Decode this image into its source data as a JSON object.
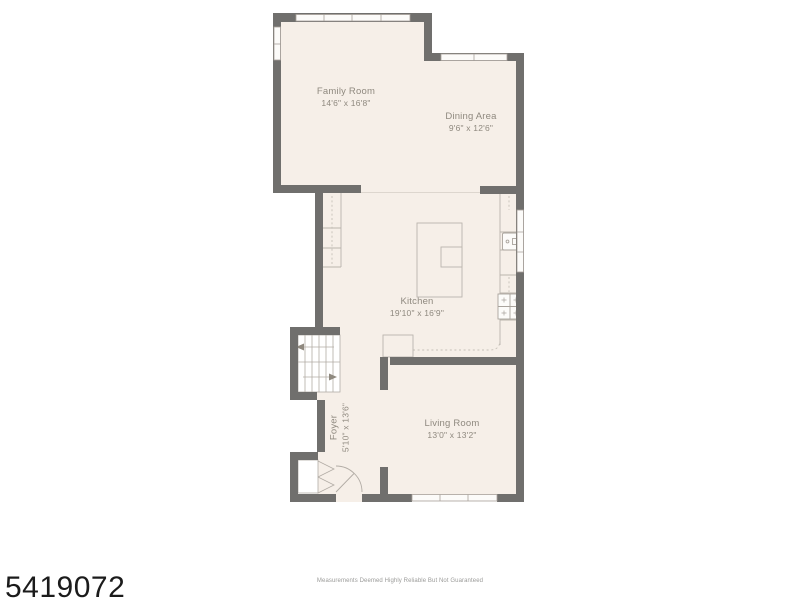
{
  "rooms": {
    "family": {
      "name": "Family Room",
      "dims": "14'6\" x 16'8\""
    },
    "dining": {
      "name": "Dining Area",
      "dims": "9'6\" x 12'6\""
    },
    "kitchen": {
      "name": "Kitchen",
      "dims": "19'10\" x 16'9\""
    },
    "living": {
      "name": "Living Room",
      "dims": "13'0\" x 13'2\""
    },
    "foyer": {
      "name": "Foyer",
      "dims": "5'10\" x 13'6\""
    }
  },
  "footer": {
    "listing_number": "5419072",
    "disclaimer": "Measurements Deemed Highly Reliable But Not Guaranteed"
  },
  "colors": {
    "wall": "#706f6d",
    "floor": "#f6efe8",
    "fixture_line": "#b2aca5",
    "label_text": "#8f897f"
  }
}
